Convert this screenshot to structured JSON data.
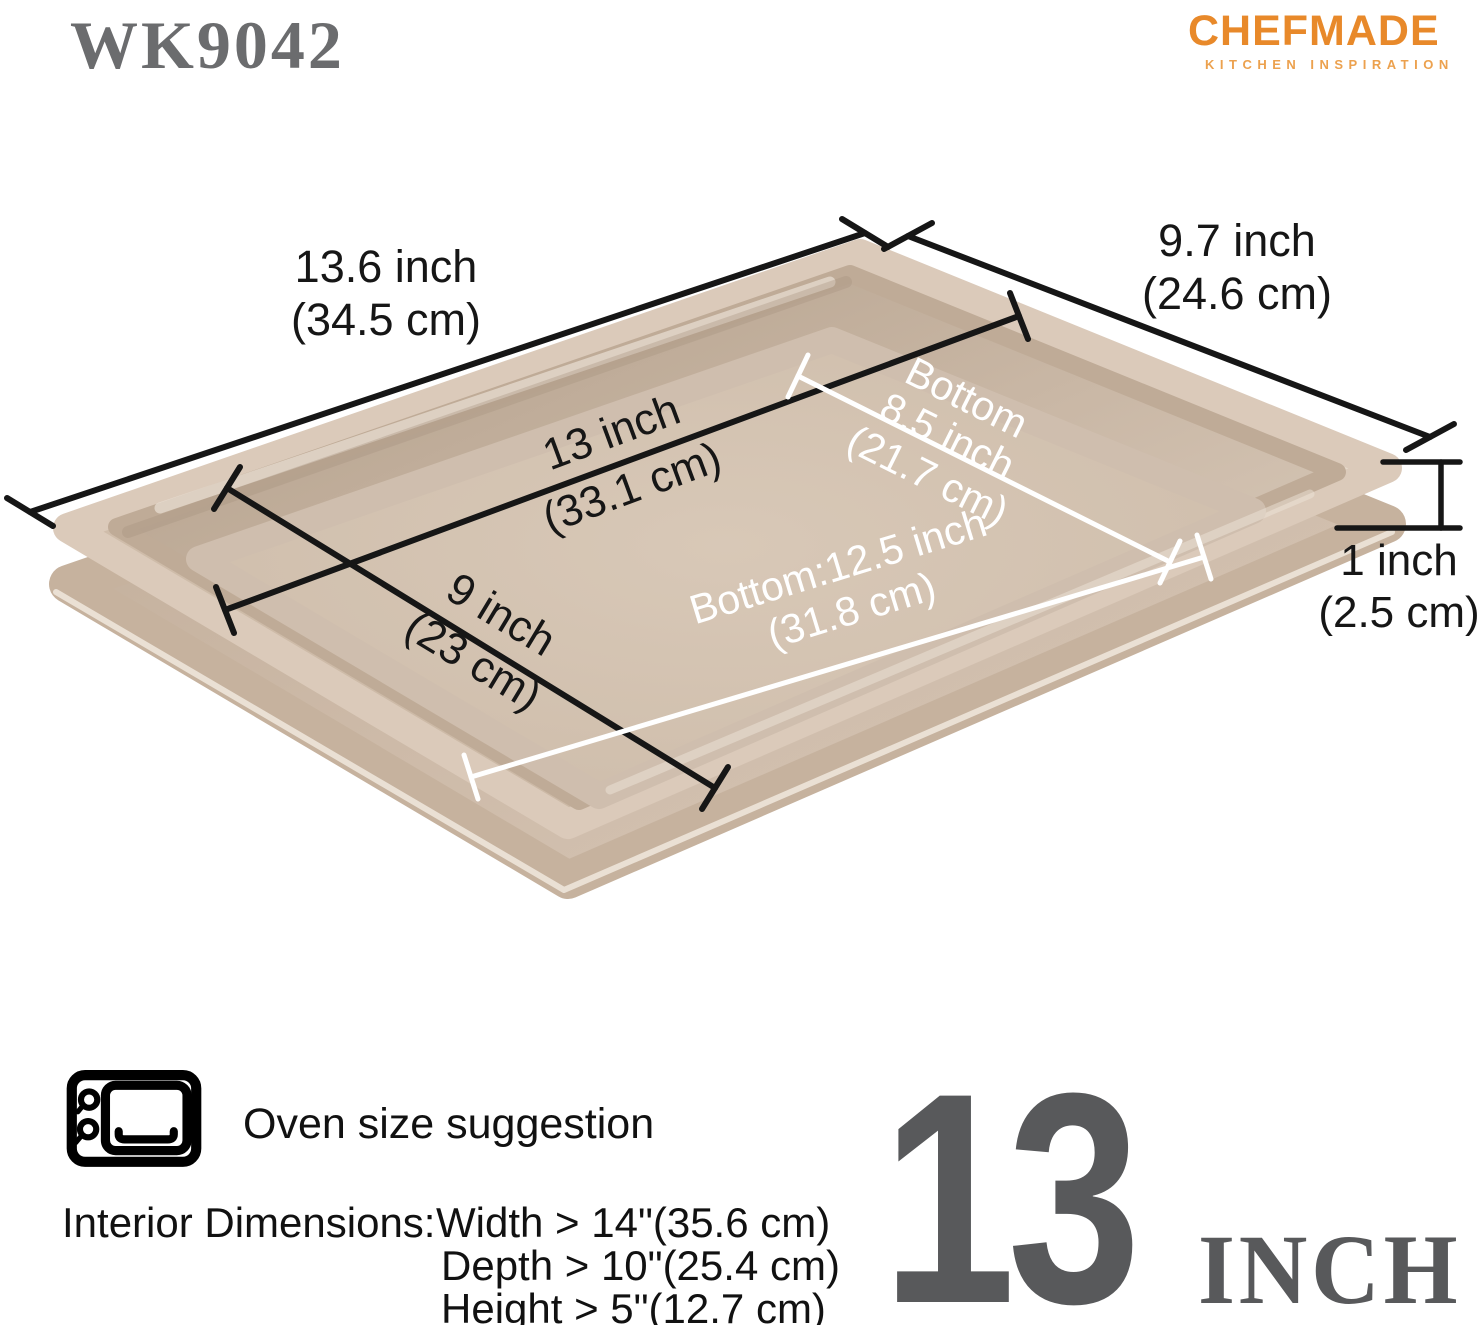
{
  "header": {
    "model": "WK9042",
    "brand": "CHEFMADE",
    "brand_tagline": "KITCHEN INSPIRATION"
  },
  "pan_labels": {
    "overall_length": {
      "inch": "13.6 inch",
      "cm": "(34.5 cm)"
    },
    "overall_width": {
      "inch": "9.7 inch",
      "cm": "(24.6 cm)"
    },
    "inner_length": {
      "inch": "13 inch",
      "cm": "(33.1 cm)"
    },
    "inner_width": {
      "inch": "9 inch",
      "cm": "(23 cm)"
    },
    "bottom_width": {
      "word": "Bottom",
      "inch": "8.5 inch",
      "cm": "(21.7 cm)"
    },
    "bottom_length": {
      "inch": "Bottom:12.5 inch",
      "cm": "(31.8 cm)"
    },
    "height": {
      "inch": "1 inch",
      "cm": "(2.5 cm)"
    }
  },
  "footer": {
    "oven_label": "Oven size suggestion",
    "interior_title": "Interior Dimensions:",
    "interior_rows": [
      "Width > 14\"(35.6 cm)",
      "Depth > 10\"(25.4 cm)",
      "Height > 5\"(12.7 cm)"
    ],
    "size_number": "13",
    "size_unit": "INCH"
  },
  "colors": {
    "brand_orange": "#E8892A",
    "tagline_orange": "#ECA14E",
    "model_gray": "#6B6C6E",
    "callout_gray": "#58595B",
    "dim_line_black": "#161616",
    "dim_line_white": "#FFFFFF",
    "pan_champagne": "#D5C4B2"
  }
}
